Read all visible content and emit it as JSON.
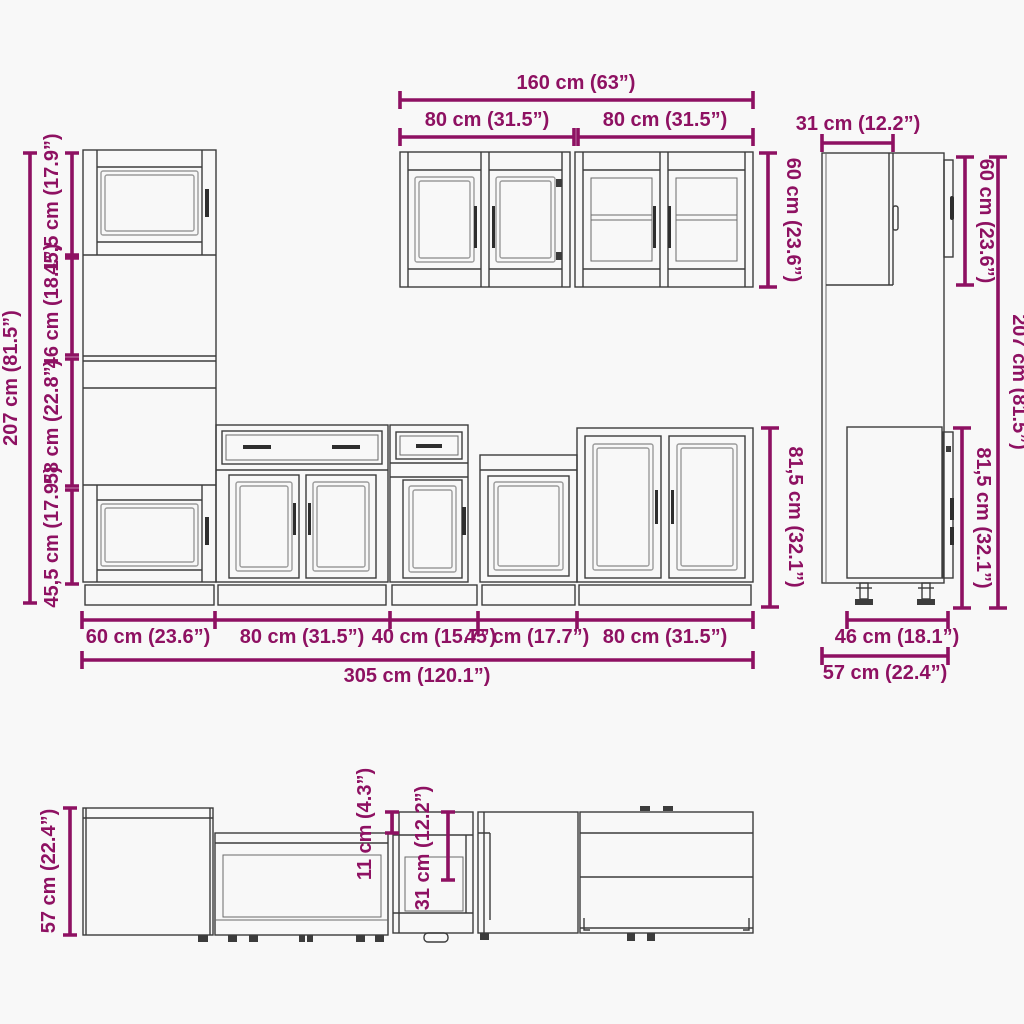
{
  "drawing": {
    "type": "kitchen-cabinet-set-technical-drawing",
    "views": [
      "front-elevation",
      "side-elevation",
      "top-plan"
    ]
  },
  "colors": {
    "dimension": "#8e1162",
    "line": "#3c3c3c",
    "background": "#f8f8f8"
  },
  "dims": {
    "left_total_height": "207 cm (81.5”)",
    "left_segments": [
      "45,5 cm (17.9”)",
      "46 cm (18.1”)",
      "58 cm (22.8”)",
      "45,5 cm (17.9”)"
    ],
    "wall_total_width": "160 cm (63”)",
    "wall_left_width": "80 cm (31.5”)",
    "wall_right_width": "80 cm (31.5”)",
    "wall_height": "60 cm (23.6”)",
    "side_top_depth": "31 cm (12.2”)",
    "side_wall_height": "60 cm (23.6”)",
    "side_total_height": "207 cm (81.5”)",
    "side_base_height": "81,5 cm (32.1”)",
    "base_height": "81,5 cm (32.1”)",
    "base_widths": [
      "60 cm (23.6”)",
      "80 cm (31.5”)",
      "40 cm (15.7”)",
      "45 cm (17.7”)",
      "80 cm (31.5”)"
    ],
    "total_width": "305 cm (120.1”)",
    "side_base_depth": "46 cm (18.1”)",
    "side_total_depth": "57 cm (22.4”)",
    "plan_total_depth": "57 cm (22.4”)",
    "plan_offset": "11 cm (4.3”)",
    "plan_appliance_depth": "31 cm (12.2”)"
  }
}
